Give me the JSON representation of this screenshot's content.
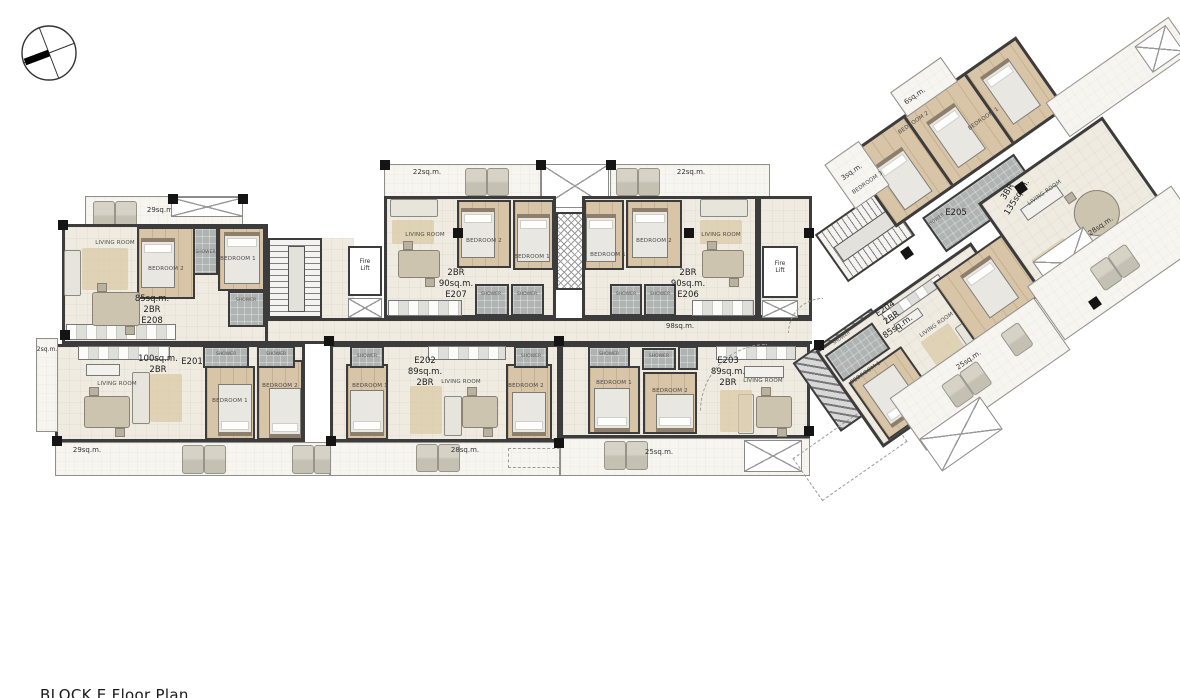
{
  "caption": "BLOCK E Floor Plan",
  "room_labels": {
    "living_room": "LIVING ROOM",
    "bedroom1": "BEDROOM 1",
    "bedroom2": "BEDROOM 2",
    "bedroom3": "BEDROOM 3",
    "shower": "SHOWER",
    "fire_lift": [
      "Fire",
      "Lift"
    ]
  },
  "corridor_area": "98sq.m.",
  "units": {
    "e208": [
      "85sq.m.",
      "2BR",
      "E208"
    ],
    "e207": [
      "2BR",
      "90sq.m.",
      "E207"
    ],
    "e206": [
      "2BR",
      "90sq.m.",
      "E206"
    ],
    "e201": [
      "100sq.m.",
      "2BR"
    ],
    "e201_id": "E201",
    "e202": [
      "E202",
      "89sq.m.",
      "2BR"
    ],
    "e203": [
      "E203",
      "89sq.m.",
      "2BR"
    ],
    "e204": [
      "E204",
      "2BR",
      "85sq.m."
    ],
    "e205_id": "E205",
    "e205": [
      "3BR",
      "135sq.m."
    ]
  },
  "balconies": {
    "top_left": "29sq.m.",
    "top_mid": "22sq.m.",
    "top_right": "22sq.m.",
    "side_left": "2sq.m.",
    "bottom_left": "29sq.m.",
    "bottom_mid": "28sq.m.",
    "bottom_right": "25sq.m.",
    "wing_top": "6sq.m.",
    "wing_left": "3sq.m.",
    "wing_e204": "25sq.m.",
    "wing_e205": "28sq.m."
  }
}
